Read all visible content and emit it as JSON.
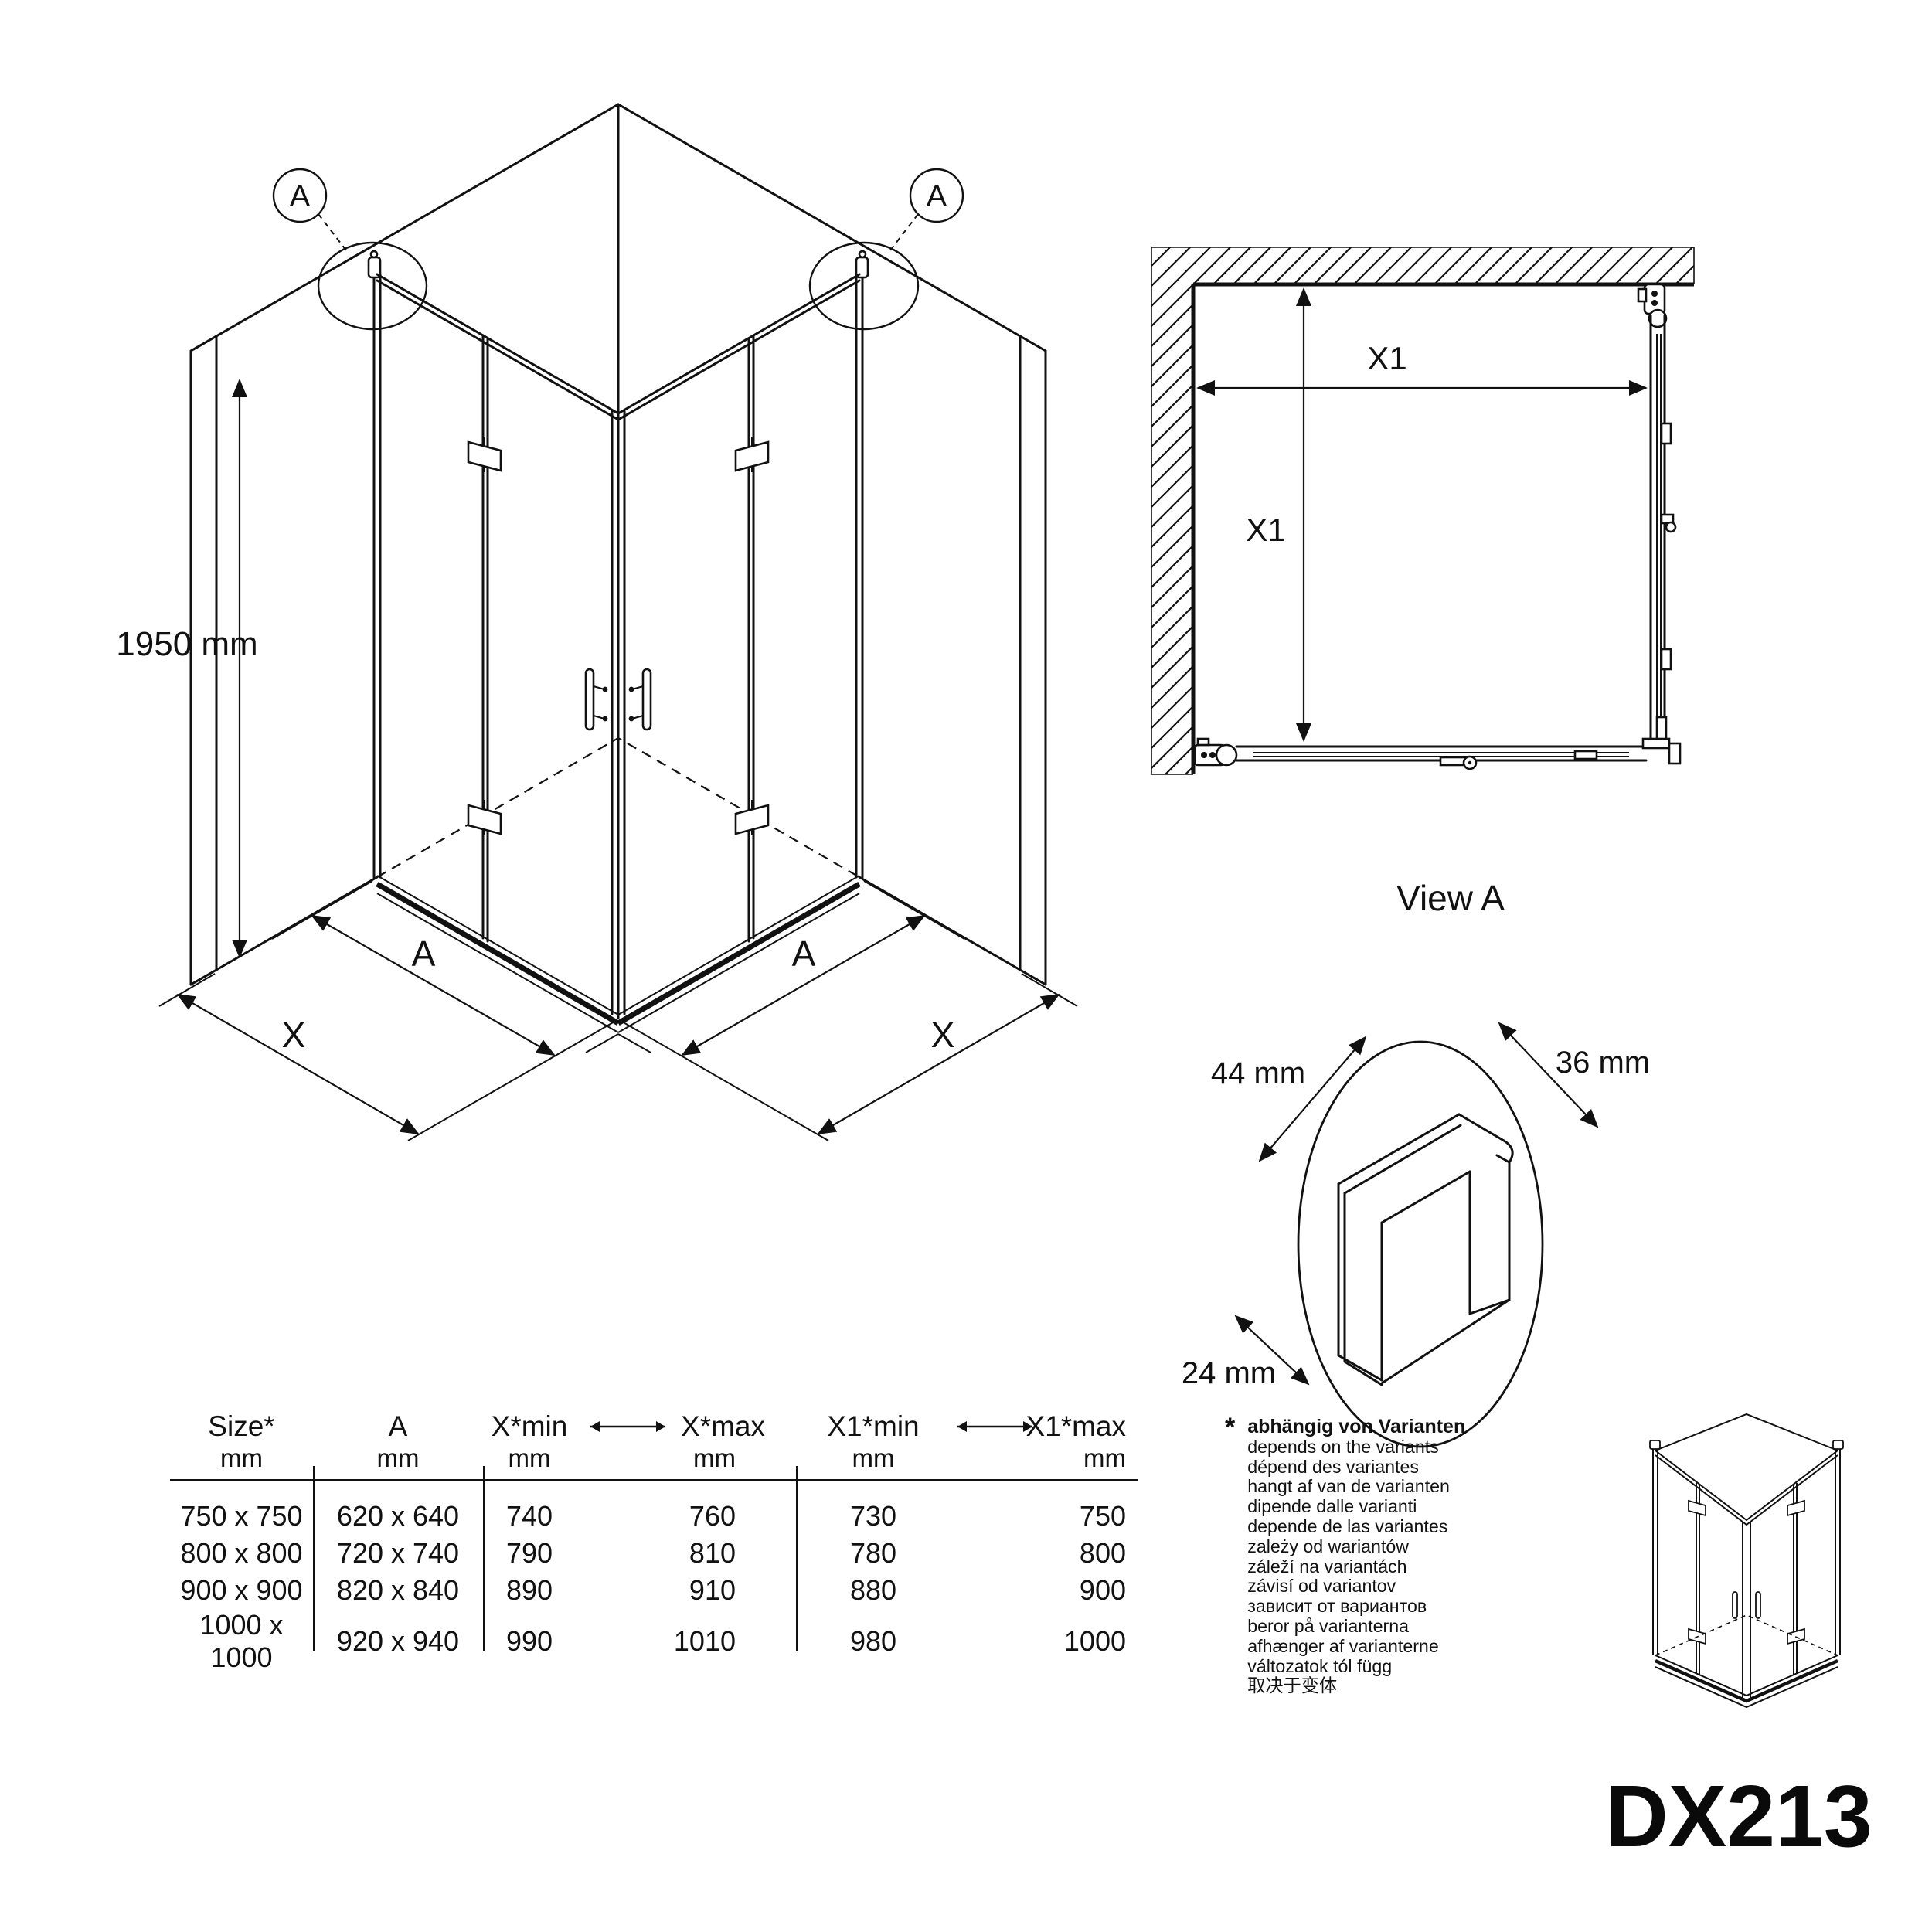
{
  "model_code": "DX213",
  "iso_view": {
    "callouts": {
      "left": "A",
      "right": "A"
    },
    "height_dim": "1950 mm",
    "bottom_dims": {
      "a_left": "A",
      "x_left": "X",
      "a_right": "A",
      "x_right": "X"
    }
  },
  "plan_view": {
    "title": "View A",
    "dim_width": "X1",
    "dim_depth": "X1"
  },
  "detail_view": {
    "dim_top_left": "44 mm",
    "dim_top_right": "36 mm",
    "dim_bottom_left": "24 mm"
  },
  "size_table": {
    "headers": {
      "size": "Size*",
      "a": "A",
      "x_min": "X*min",
      "x_max": "X*max",
      "x1_min": "X1*min",
      "x1_max": "X1*max"
    },
    "unit": "mm",
    "rows": [
      {
        "size": "750 x 750",
        "a": "620 x 640",
        "x_min": "740",
        "x_max": "760",
        "x1_min": "730",
        "x1_max": "750"
      },
      {
        "size": "800 x 800",
        "a": "720 x 740",
        "x_min": "790",
        "x_max": "810",
        "x1_min": "780",
        "x1_max": "800"
      },
      {
        "size": "900 x 900",
        "a": "820 x 840",
        "x_min": "890",
        "x_max": "910",
        "x1_min": "880",
        "x1_max": "900"
      },
      {
        "size": "1000 x 1000",
        "a": "920 x 940",
        "x_min": "990",
        "x_max": "1010",
        "x1_min": "980",
        "x1_max": "1000"
      }
    ]
  },
  "footnote": {
    "symbol": "*",
    "primary": "abhängig von Varianten",
    "translations": [
      "depends on the variants",
      "dépend des variantes",
      "hangt af van de varianten",
      "dipende dalle varianti",
      "depende de las variantes",
      "zależy od wariantów",
      "záleží na variantách",
      "závisí od variantov",
      "зависит от вариантов",
      "beror på varianterna",
      "afhænger af varianterne",
      "változatok tól függ",
      "取决于变体"
    ]
  }
}
